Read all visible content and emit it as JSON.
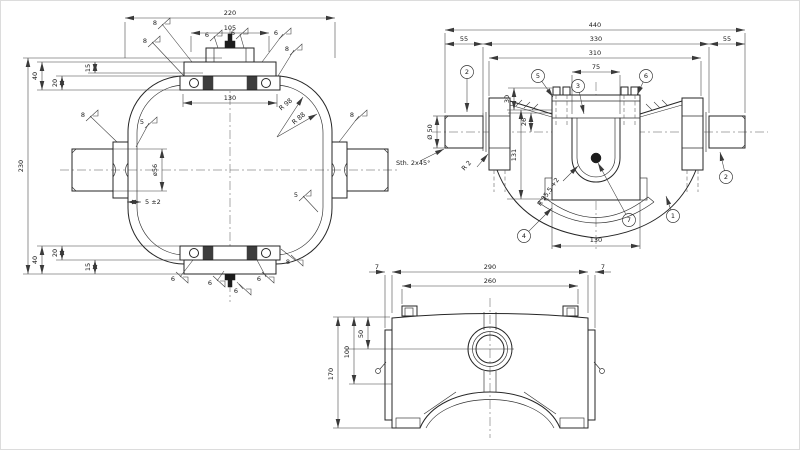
{
  "drawing": {
    "type": "technical-drawing-three-views",
    "bg": "#ffffff",
    "line_color": "#262626",
    "views": {
      "front": {
        "name": "front-view-anno",
        "labels": [
          {
            "t": "220",
            "x": 230,
            "y": 15
          },
          {
            "t": "105",
            "x": 230,
            "y": 30
          },
          {
            "t": "130",
            "x": 230,
            "y": 100
          },
          {
            "t": "230",
            "x": 23,
            "y": 166,
            "r": -90
          },
          {
            "t": "40",
            "x": 37,
            "y": 76,
            "r": -90
          },
          {
            "t": "15",
            "x": 90,
            "y": 68,
            "r": -90
          },
          {
            "t": "20",
            "x": 57,
            "y": 83,
            "r": -90
          },
          {
            "t": "40",
            "x": 37,
            "y": 260,
            "r": -90
          },
          {
            "t": "20",
            "x": 57,
            "y": 253,
            "r": -90
          },
          {
            "t": "15",
            "x": 90,
            "y": 267,
            "r": -90
          },
          {
            "t": "ø56",
            "x": 157,
            "y": 170,
            "r": -90
          },
          {
            "t": "5 ±2",
            "x": 145,
            "y": 204,
            "s": 5,
            "a": "start"
          },
          {
            "t": "R 98",
            "x": 287,
            "y": 106,
            "r": -40,
            "s": 5
          },
          {
            "t": "R 88",
            "x": 300,
            "y": 120,
            "r": -40,
            "s": 5
          }
        ],
        "finish": [
          {
            "v": "8",
            "x": 162,
            "y": 24,
            "lx": 192,
            "ly": 62
          },
          {
            "v": "8",
            "x": 152,
            "y": 42,
            "lx": 184,
            "ly": 76
          },
          {
            "v": "6",
            "x": 214,
            "y": 36,
            "lx": 218,
            "ly": 48
          },
          {
            "v": "6",
            "x": 240,
            "y": 34,
            "lx": 244,
            "ly": 48
          },
          {
            "v": "6",
            "x": 283,
            "y": 34,
            "lx": 262,
            "ly": 62
          },
          {
            "v": "8",
            "x": 294,
            "y": 50,
            "lx": 278,
            "ly": 76
          },
          {
            "v": "8",
            "x": 90,
            "y": 116,
            "lx": 117,
            "ly": 142
          },
          {
            "v": "5",
            "x": 149,
            "y": 123,
            "lx": 136,
            "ly": 147
          },
          {
            "v": "8",
            "x": 359,
            "y": 116,
            "lx": 339,
            "ly": 142
          },
          {
            "v": "5",
            "x": 303,
            "y": 196,
            "lx": 318,
            "ly": 212
          },
          {
            "v": "6",
            "x": 180,
            "y": 277,
            "lx": 193,
            "ly": 260,
            "m": 1
          },
          {
            "v": "6",
            "x": 217,
            "y": 281,
            "lx": 224,
            "ly": 271,
            "m": 1
          },
          {
            "v": "6",
            "x": 243,
            "y": 289,
            "lx": 237,
            "ly": 282,
            "m": 1
          },
          {
            "v": "6",
            "x": 266,
            "y": 277,
            "lx": 257,
            "ly": 260,
            "m": 1
          },
          {
            "v": "8",
            "x": 295,
            "y": 260,
            "lx": 281,
            "ly": 249,
            "m": 1
          }
        ]
      },
      "side": {
        "name": "side-view-anno",
        "labels": [
          {
            "t": "440",
            "x": 595,
            "y": 27
          },
          {
            "t": "55",
            "x": 464,
            "y": 41
          },
          {
            "t": "330",
            "x": 596,
            "y": 41
          },
          {
            "t": "55",
            "x": 727,
            "y": 41
          },
          {
            "t": "310",
            "x": 595,
            "y": 55
          },
          {
            "t": "75",
            "x": 596,
            "y": 69
          },
          {
            "t": "130",
            "x": 596,
            "y": 242
          },
          {
            "t": "131",
            "x": 516,
            "y": 155,
            "r": -90
          },
          {
            "t": "26",
            "x": 526,
            "y": 122,
            "r": -90
          },
          {
            "t": "30",
            "x": 509,
            "y": 99,
            "r": -90
          },
          {
            "t": "Ø 50",
            "x": 432,
            "y": 132,
            "r": -90
          },
          {
            "t": "Sth. 2x45°",
            "x": 396,
            "y": 165,
            "s": 5,
            "a": "start"
          },
          {
            "t": "R 2",
            "x": 468,
            "y": 167,
            "r": -48,
            "s": 5
          },
          {
            "t": "R 25,5 +2",
            "x": 550,
            "y": 193,
            "r": -55,
            "s": 5
          }
        ],
        "balloons": [
          {
            "n": "2",
            "x": 467,
            "y": 72,
            "lx": 467,
            "ly": 112
          },
          {
            "n": "5",
            "x": 538,
            "y": 76,
            "lx": 553,
            "ly": 97
          },
          {
            "n": "3",
            "x": 578,
            "y": 86,
            "lx": 584,
            "ly": 114
          },
          {
            "n": "6",
            "x": 646,
            "y": 76,
            "lx": 637,
            "ly": 95
          },
          {
            "n": "1",
            "x": 673,
            "y": 216,
            "lx": 666,
            "ly": 196
          },
          {
            "n": "7",
            "x": 629,
            "y": 220,
            "lx": 598,
            "ly": 163
          },
          {
            "n": "2",
            "x": 726,
            "y": 177,
            "lx": 720,
            "ly": 152
          },
          {
            "n": "4",
            "x": 524,
            "y": 236,
            "lx": 552,
            "ly": 208
          }
        ]
      },
      "bottom": {
        "name": "bottom-view-anno",
        "labels": [
          {
            "t": "290",
            "x": 490,
            "y": 269
          },
          {
            "t": "260",
            "x": 490,
            "y": 283
          },
          {
            "t": "7",
            "x": 377,
            "y": 269
          },
          {
            "t": "7",
            "x": 603,
            "y": 269
          },
          {
            "t": "170",
            "x": 333,
            "y": 374,
            "r": -90
          },
          {
            "t": "100",
            "x": 349,
            "y": 352,
            "r": -90
          },
          {
            "t": "50",
            "x": 363,
            "y": 334,
            "r": -90
          }
        ]
      }
    }
  }
}
